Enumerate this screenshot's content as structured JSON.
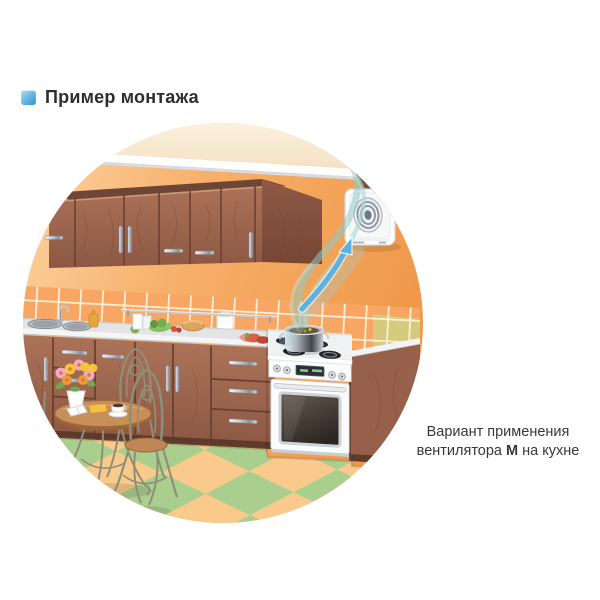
{
  "header": {
    "icon": "blue-square-bullet-icon",
    "title": "Пример монтажа"
  },
  "caption": {
    "line1": "Вариант применения",
    "line2_before": "вентилятора ",
    "line2_bold": "М",
    "line2_after": " на кухне"
  },
  "illustration": {
    "type": "vector-kitchen-scene-in-circle",
    "palette": {
      "wall_orange": "#F5A55B",
      "ceiling_cream": "#F6E8CF",
      "cabinet_brown": "#9E6A50",
      "tile_orange": "#F7A763",
      "tile_grout": "#FFF1D8",
      "counter_gray": "#E2E4E7",
      "stove_white": "#FBFCFD",
      "floor_peach": "#F9CA8C",
      "floor_green": "#A9CE8E",
      "steam_teal": "#8FC9C6",
      "arrow_blue": "#58B2E4",
      "fan_white": "#FEFEFE",
      "bullet_blue_top": "#8FD0F0",
      "bullet_blue_bottom": "#2F8FCC",
      "text_dark": "#333333"
    }
  }
}
